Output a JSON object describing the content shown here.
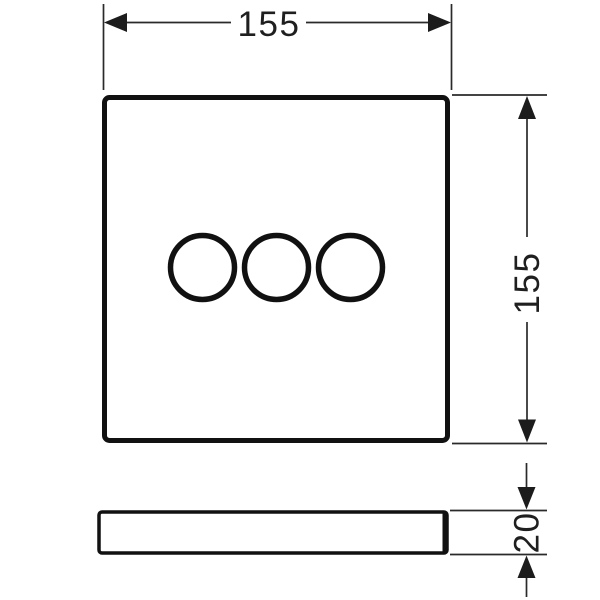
{
  "drawing": {
    "kind": "technical-dimension-drawing",
    "colors": {
      "line": "#1c1c1c",
      "background": "#ffffff"
    },
    "front_view": {
      "shape": "square-plate",
      "circle_count": 3
    },
    "side_view": {
      "shape": "thin-plate-profile"
    },
    "dimensions": {
      "width": {
        "label": "155"
      },
      "height": {
        "label": "155"
      },
      "thickness": {
        "label": "20"
      }
    }
  }
}
